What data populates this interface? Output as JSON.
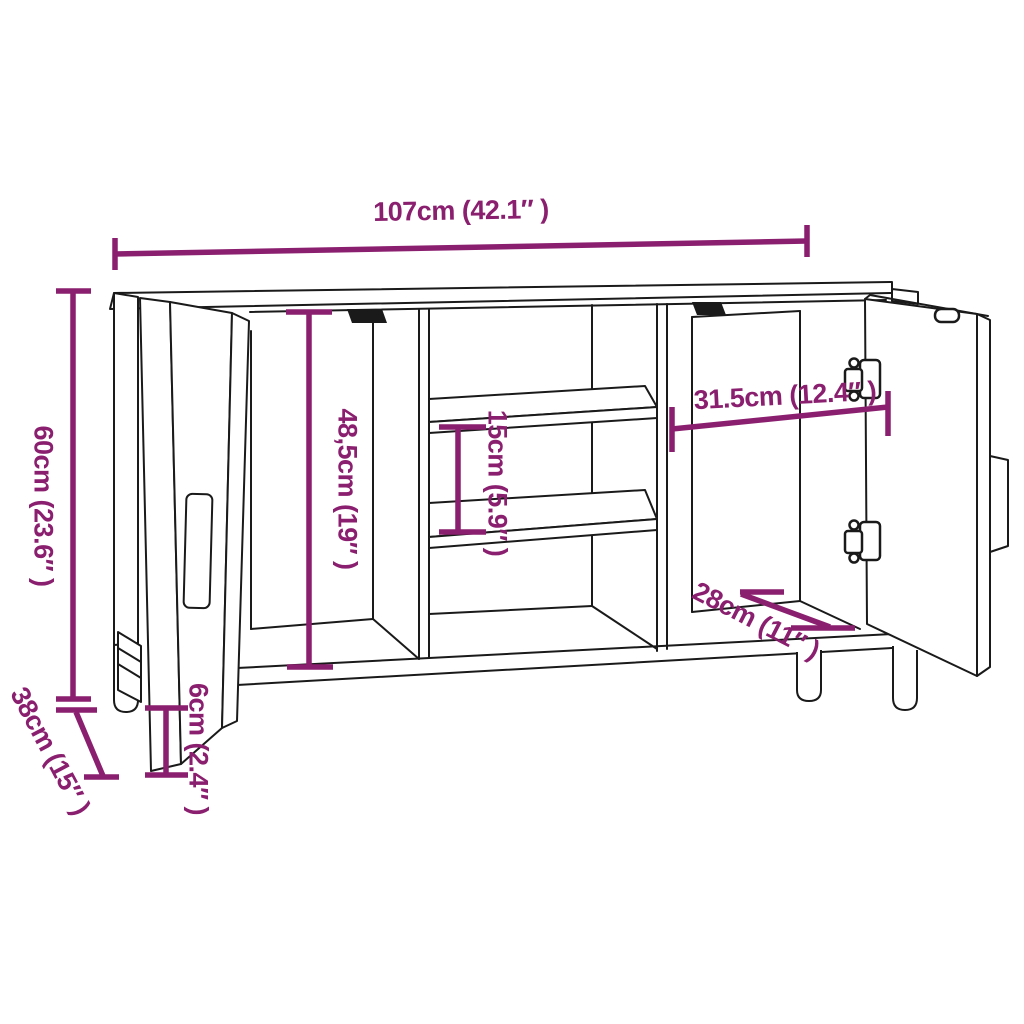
{
  "colors": {
    "annotation": "#8B1F6F",
    "line": "#1a1a1a",
    "background": "#ffffff"
  },
  "dimensions": {
    "overall_width": {
      "label": "107cm (42.1″ )"
    },
    "overall_height": {
      "label": "60cm (23.6″ )"
    },
    "overall_depth": {
      "label": "38cm (15″ )"
    },
    "leg_height": {
      "label": "6cm (2.4″ )"
    },
    "left_inner_height": {
      "label": "48,5cm (19″ )"
    },
    "shelf_gap": {
      "label": "15cm (5.9″ )"
    },
    "right_inner_width": {
      "label": "31.5cm (12.4″ )"
    },
    "right_inner_depth": {
      "label": "28cm (11″ )"
    }
  }
}
